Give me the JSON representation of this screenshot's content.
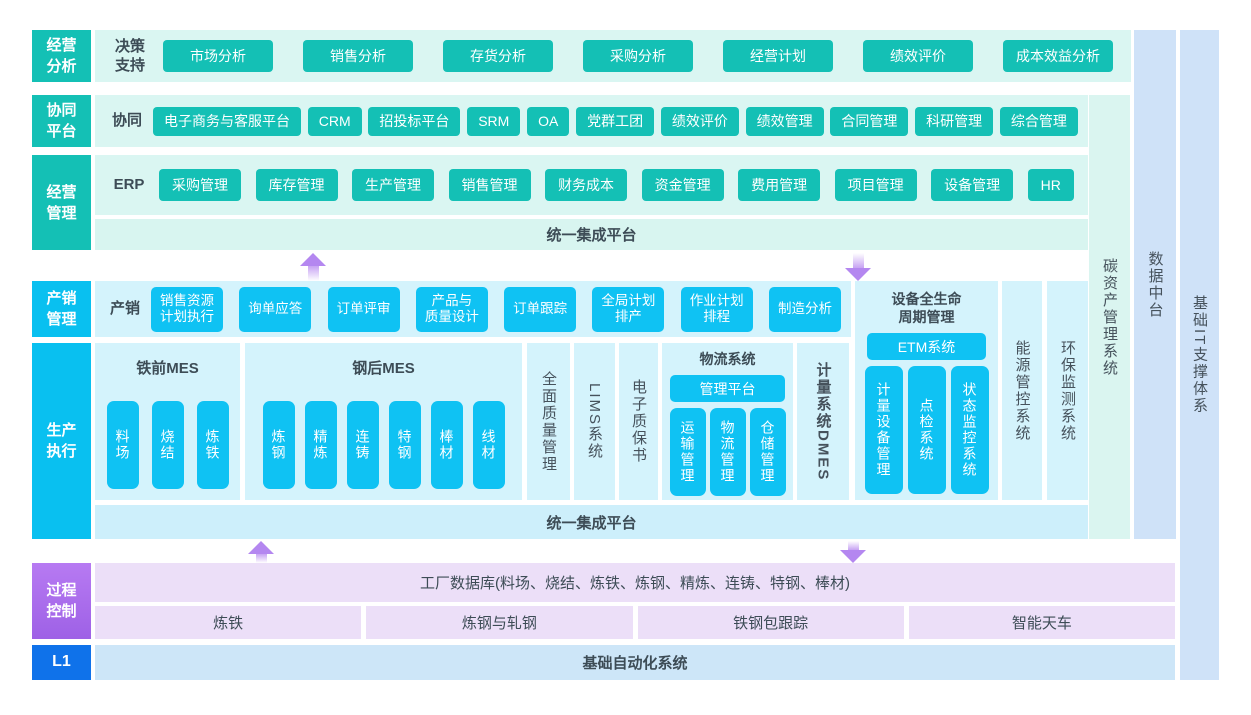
{
  "rows": {
    "analysis": {
      "label": "经营\n分析",
      "sub": "决策\n支持",
      "buttons": [
        "市场分析",
        "销售分析",
        "存货分析",
        "采购分析",
        "经营计划",
        "绩效评价",
        "成本效益分析"
      ]
    },
    "collab": {
      "label": "协同\n平台",
      "sub": "协同",
      "buttons": [
        "电子商务与客服平台",
        "CRM",
        "招投标平台",
        "SRM",
        "OA",
        "党群工团",
        "绩效评价",
        "绩效管理",
        "合同管理",
        "科研管理",
        "综合管理"
      ]
    },
    "mgmt": {
      "label": "经营\n管理",
      "sub": "ERP",
      "buttons": [
        "采购管理",
        "库存管理",
        "生产管理",
        "销售管理",
        "财务成本",
        "资金管理",
        "费用管理",
        "项目管理",
        "设备管理",
        "HR"
      ],
      "band": "统一集成平台"
    },
    "sales": {
      "label": "产销\n管理",
      "sub": "产销",
      "buttons": [
        "销售资源\n计划执行",
        "询单应答",
        "订单评审",
        "产品与\n质量设计",
        "订单跟踪",
        "全局计划\n排产",
        "作业计划\n排程",
        "制造分析"
      ]
    },
    "production": {
      "label": "生产\n执行",
      "iron_mes": {
        "title": "铁前MES",
        "buttons": [
          "料场",
          "烧结",
          "炼铁"
        ]
      },
      "steel_mes": {
        "title": "钢后MES",
        "buttons": [
          "炼钢",
          "精炼",
          "连铸",
          "特钢",
          "棒材",
          "线材"
        ]
      },
      "quality_col": "全面质量管理",
      "lims_col": "LIMS系统",
      "cert_col": "电子质保书",
      "logistics": {
        "title": "物流系统",
        "platform": "管理平台",
        "buttons": [
          "运输管理",
          "物流管理",
          "仓储管理"
        ]
      },
      "metering_col": "计量系统DMES",
      "band": "统一集成平台"
    },
    "equipment": {
      "title": "设备全生命\n周期管理",
      "etm": "ETM系统",
      "buttons": [
        "计量设备管理",
        "点检系统",
        "状态监控系统"
      ]
    },
    "energy_col": "能源管控系统",
    "env_col": "环保监测系统",
    "process": {
      "label": "过程\n控制",
      "db_band": "工厂数据库(料场、烧结、炼铁、炼钢、精炼、连铸、特钢、棒材)",
      "cells": [
        "炼铁",
        "炼钢与轧钢",
        "铁钢包跟踪",
        "智能天车"
      ]
    },
    "l1": {
      "label": "L1",
      "band": "基础自动化系统"
    }
  },
  "side": {
    "carbon": "碳资产管理系统",
    "data_mid": "数据中台",
    "it_base": "基础IT支撑体系"
  },
  "colors": {
    "teal": "#14c0b5",
    "cyan": "#0fc2f3",
    "purple": "#a76ee9",
    "blue": "#0f72ea",
    "light_teal": "#daf6f2",
    "light_cyan": "#d4f3fc",
    "light_purple": "#ecdff8",
    "light_blue": "#cfe2f8",
    "arrow": "#b487f0"
  }
}
